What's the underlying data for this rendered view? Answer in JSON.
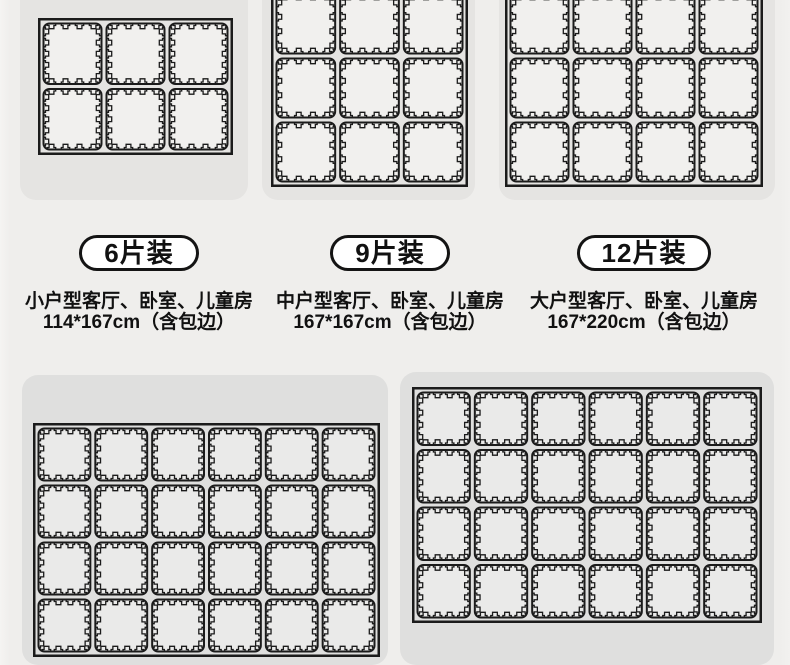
{
  "colors": {
    "page_bg": "#efeeec",
    "card_bg_top": "#e5e4e2",
    "card_bg_bottom": "#dfdfde",
    "tile_fill_top": "#f1f0ee",
    "tile_fill_bottom": "#eaeae9",
    "line": "#1b1b1b",
    "badge_bg": "#ffffff",
    "badge_border": "#141414",
    "text": "#111111"
  },
  "products": [
    {
      "badge_label": "6片装",
      "pieces": 6,
      "grid": {
        "cols": 3,
        "rows": 2
      },
      "desc_line1": "小户型客厅、卧室、儿童房",
      "desc_line2": "114*167cm（含包边）"
    },
    {
      "badge_label": "9片装",
      "pieces": 9,
      "grid": {
        "cols": 3,
        "rows": 3
      },
      "desc_line1": "中户型客厅、卧室、儿童房",
      "desc_line2": "167*167cm（含包边）"
    },
    {
      "badge_label": "12片装",
      "pieces": 12,
      "grid": {
        "cols": 4,
        "rows": 3
      },
      "desc_line1": "大户型客厅、卧室、儿童房",
      "desc_line2": "167*220cm（含包边）"
    }
  ],
  "partial_mats": [
    {
      "grid": {
        "cols": 6,
        "rows": 4
      }
    },
    {
      "grid": {
        "cols": 6,
        "rows": 4
      }
    }
  ]
}
